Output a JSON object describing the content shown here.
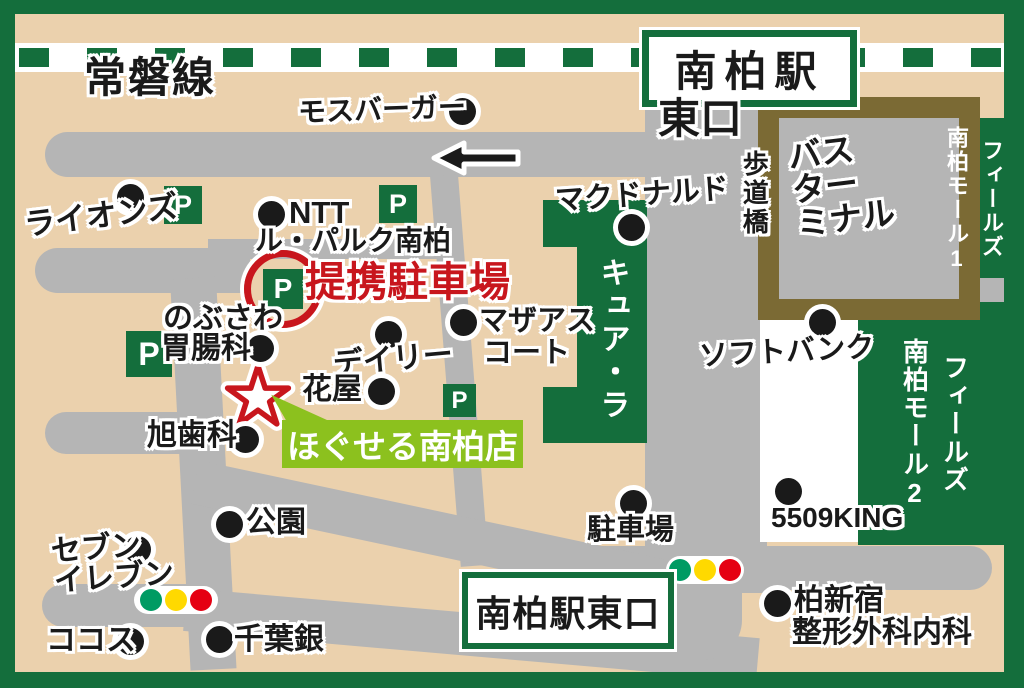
{
  "colors": {
    "green": "#146e3c",
    "tan": "#ebd1ad",
    "gray": "#b5b5b5",
    "brown": "#7b6a34",
    "lime": "#8cc11e",
    "red": "#c8161d",
    "sig-green": "#009b63",
    "sig-yellow": "#ffd900",
    "sig-red": "#e50012"
  },
  "labels": {
    "joban_line": "常磐線",
    "station": "南柏駅",
    "east_exit": "東口",
    "east_exit_sign": "南柏駅東口",
    "pedestrian_bridge": "歩道橋",
    "bus_terminal": [
      "バス",
      "ター",
      "ミナル"
    ],
    "fields_mall1": [
      "フィールズ",
      "南柏モール1"
    ],
    "fields_mall2": [
      "フィールズ",
      "南柏モール2"
    ],
    "mos_burger": "モスバーガー",
    "mcdonalds": "マクドナルド",
    "lions": "ライオンズ",
    "ntt": "NTT",
    "le_parc": "ル・パルク南柏",
    "partner_parking": "提携駐車場",
    "cure_la": "キュア・ラ",
    "mothers_court_l1": "マザアス",
    "mothers_court_l2": "コート",
    "nobusawa_l1": "のぶさわ",
    "nobusawa_l2": "胃腸科",
    "daily": "デイリー",
    "flower_shop": "花屋",
    "asahi_dental": "旭歯科",
    "store": "ほぐせる南柏店",
    "park": "公園",
    "seven_l1": "セブン",
    "seven_l2": "イレブン",
    "cocos": "ココス",
    "chiba_bank": "千葉銀",
    "parking_lot": "駐車場",
    "softbank": "ソフトバンク",
    "king": "5509KING",
    "kashiwa_clinic_l1": "柏新宿",
    "kashiwa_clinic_l2": "整形外科内科",
    "parking_letter": "P"
  }
}
